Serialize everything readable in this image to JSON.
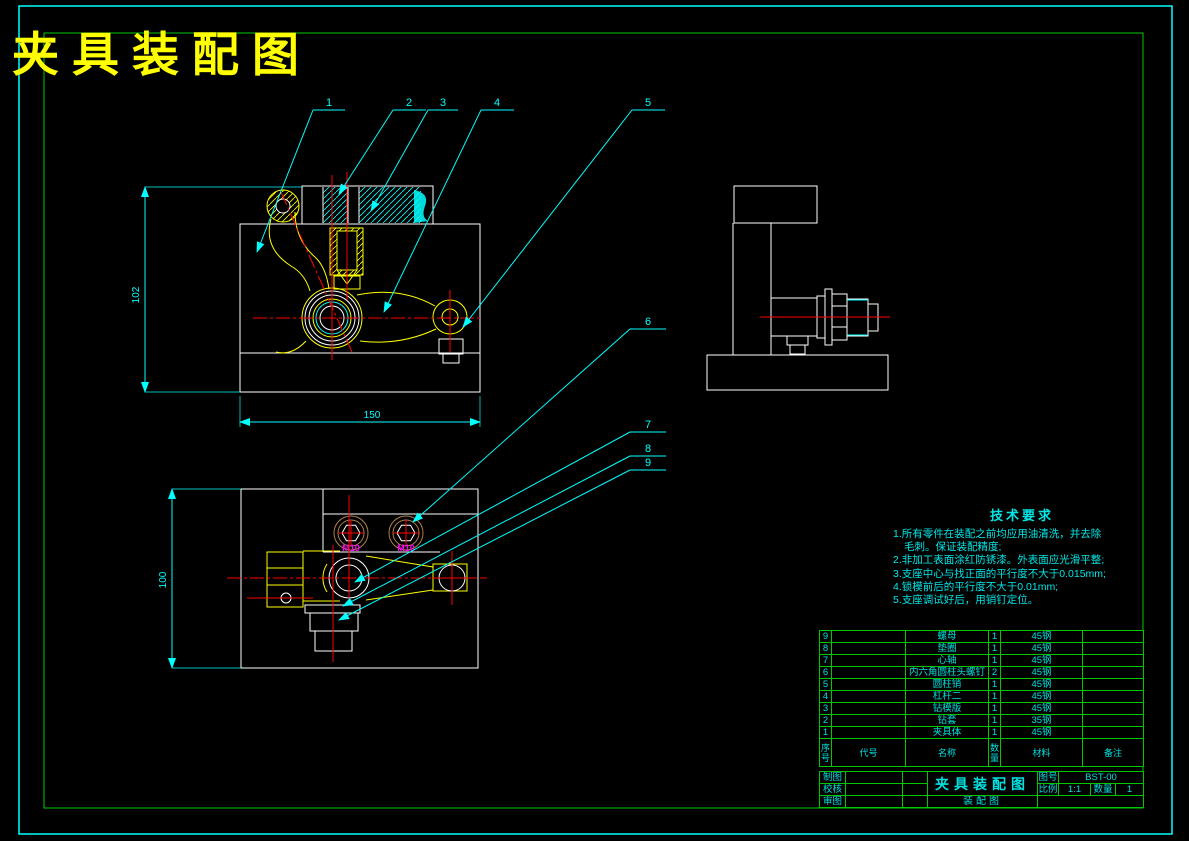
{
  "window": {
    "title": "夹具装配图"
  },
  "tech_requirements": {
    "title": "技术要求",
    "lines": [
      "1.所有零件在装配之前均应用油清洗，并去除",
      "毛刺。保证装配精度;",
      "2.非加工表面涂红防锈漆。外表面应光滑平整;",
      "3.支座中心与找正面的平行度不大于0.015mm;",
      "4.锁模前后的平行度不大于0.01mm;",
      "5.支座调试好后，用销钉定位。"
    ]
  },
  "dimensions": {
    "front_height": "102",
    "front_width": "150",
    "plan_height": "100"
  },
  "annotations": {
    "m10_left": "M10",
    "m10_right": "M10"
  },
  "leaders": [
    "1",
    "2",
    "3",
    "4",
    "5",
    "6",
    "7",
    "8",
    "9"
  ],
  "bom": {
    "headers": {
      "index": "序号",
      "code": "代号",
      "name": "名称",
      "qty": "数量",
      "material": "材料",
      "note": "备注"
    },
    "rows": [
      {
        "index": "9",
        "code": "",
        "name": "螺母",
        "qty": "1",
        "material": "45钢",
        "note": ""
      },
      {
        "index": "8",
        "code": "",
        "name": "垫圈",
        "qty": "1",
        "material": "45钢",
        "note": ""
      },
      {
        "index": "7",
        "code": "",
        "name": "心轴",
        "qty": "1",
        "material": "45钢",
        "note": ""
      },
      {
        "index": "6",
        "code": "",
        "name": "内六角圆柱头螺钉",
        "qty": "2",
        "material": "45钢",
        "note": ""
      },
      {
        "index": "5",
        "code": "",
        "name": "圆柱销",
        "qty": "1",
        "material": "45钢",
        "note": ""
      },
      {
        "index": "4",
        "code": "",
        "name": "杠杆二",
        "qty": "1",
        "material": "45钢",
        "note": ""
      },
      {
        "index": "3",
        "code": "",
        "name": "钻模版",
        "qty": "1",
        "material": "45钢",
        "note": ""
      },
      {
        "index": "2",
        "code": "",
        "name": "钻套",
        "qty": "1",
        "material": "35钢",
        "note": ""
      },
      {
        "index": "1",
        "code": "",
        "name": "夹具体",
        "qty": "1",
        "material": "45钢",
        "note": ""
      }
    ]
  },
  "title_block": {
    "drawn_label": "制图",
    "checked_label": "校核",
    "approved_label": "审图",
    "drawing_title": "夹具装配图",
    "drawing_subtitle": "装配图",
    "drawing_no_label": "图号",
    "drawing_no": "BST-00",
    "scale_label": "比例",
    "scale": "1:1",
    "qty_label": "数量",
    "qty": "1"
  },
  "colors": {
    "background": "#000000",
    "frame_outer": "#00ffff",
    "frame_inner": "#00c800",
    "title_yellow": "#ffff00",
    "part_yellow": "#ffff00",
    "outline_white": "#ffffff",
    "centerline_red": "#ff0000",
    "leader_cyan": "#00ffff",
    "label_magenta": "#ff00ff",
    "screw_tan": "#b08048"
  }
}
